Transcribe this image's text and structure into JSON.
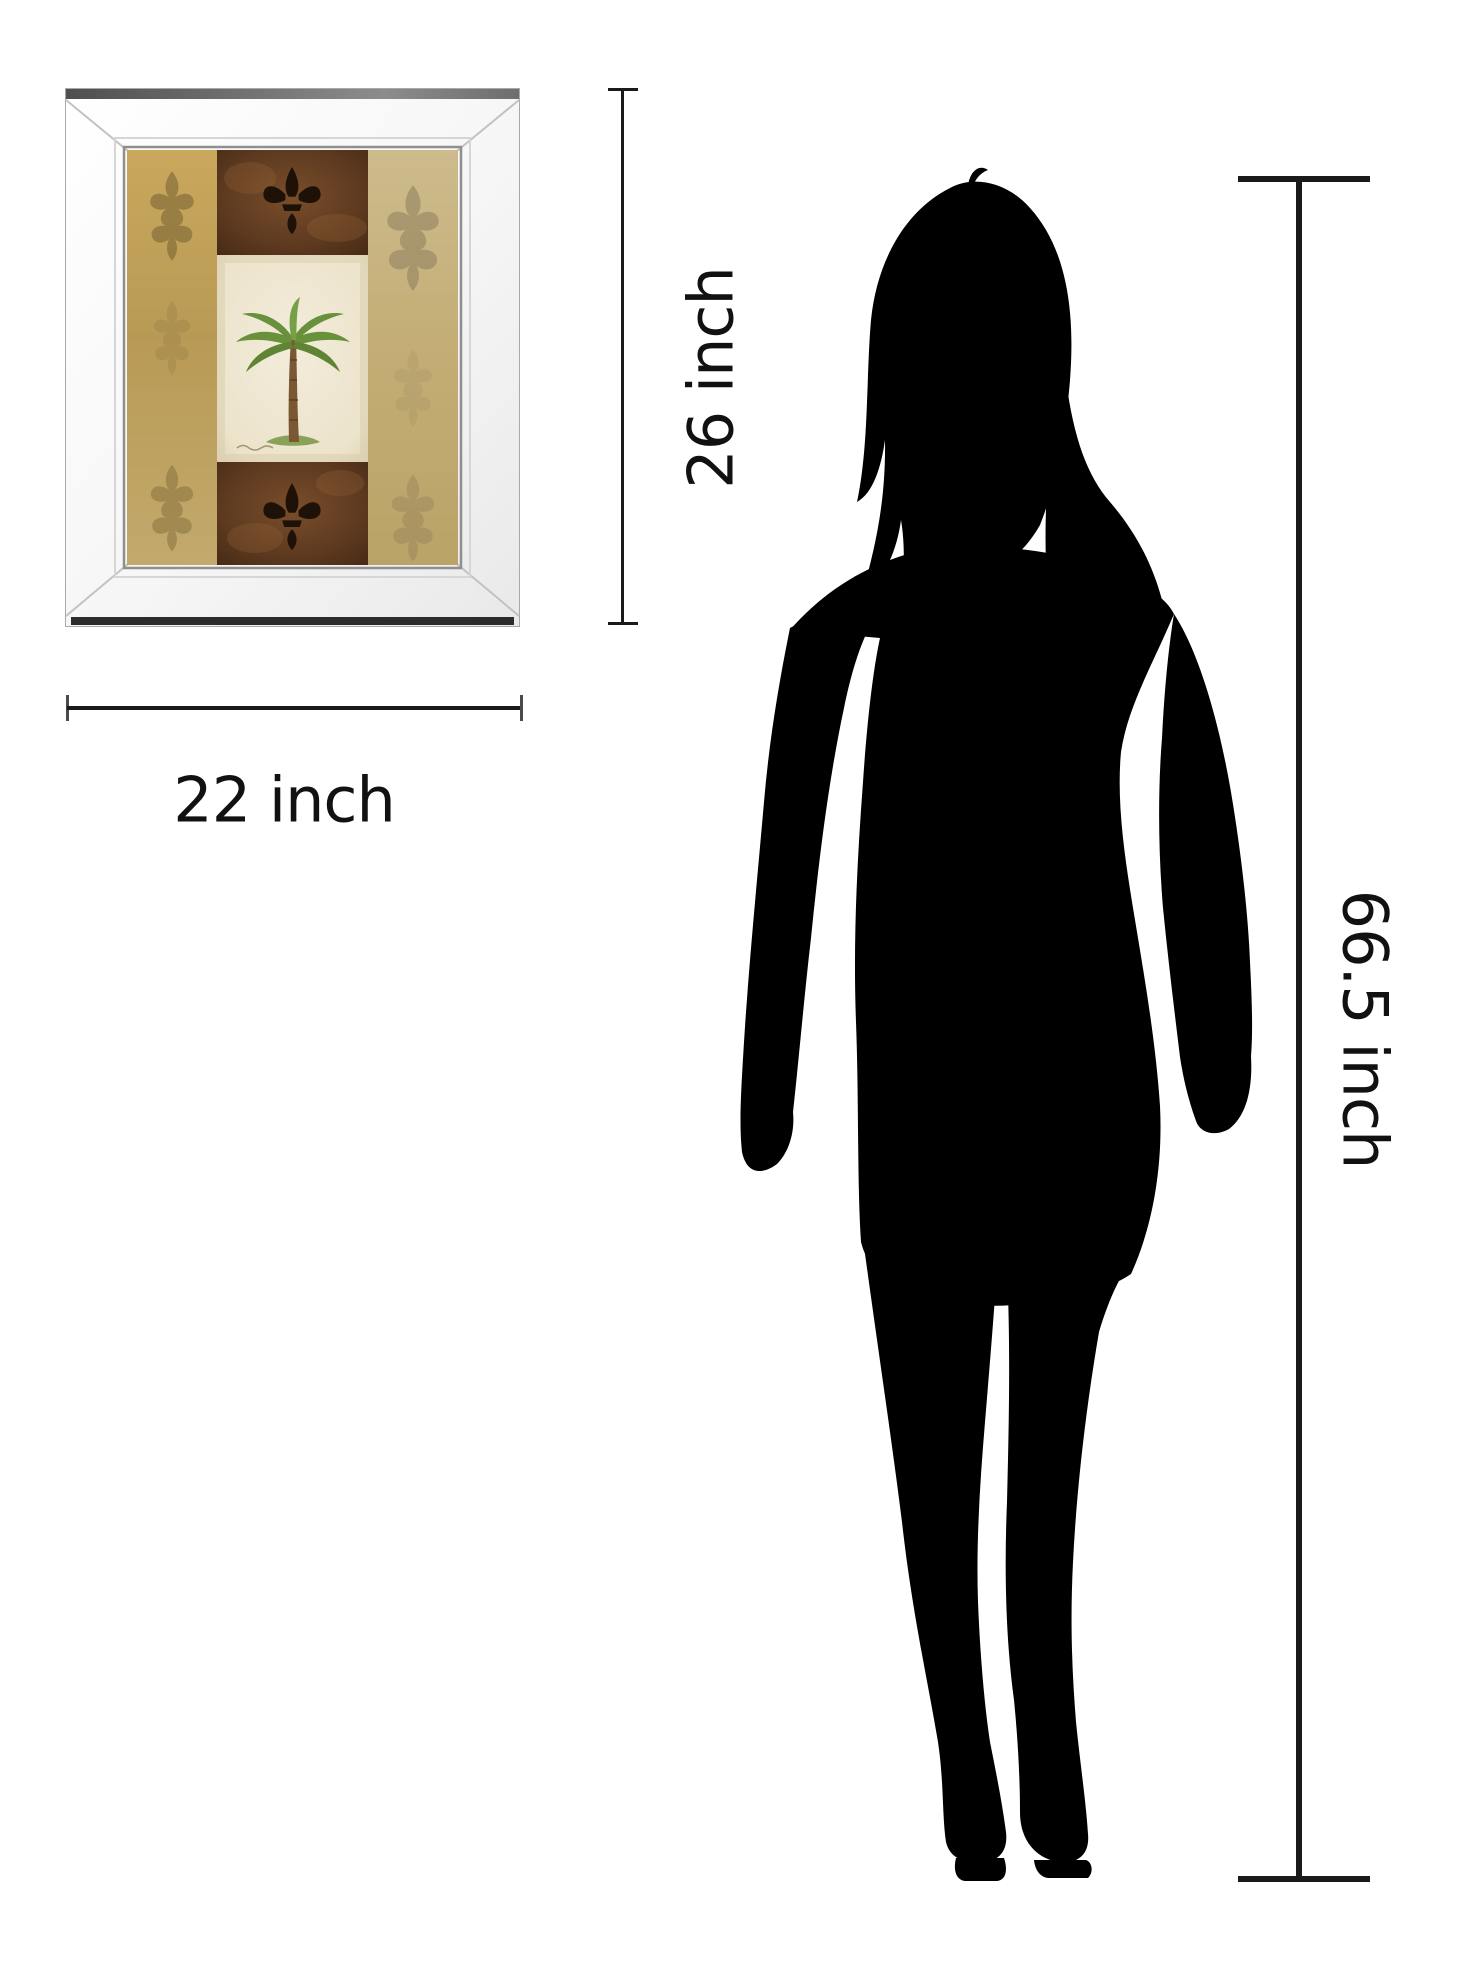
{
  "page": {
    "background": "#ffffff"
  },
  "dimensions": {
    "frame_height_label": "26 inch",
    "frame_width_label": "22 inch",
    "figure_height_label": "66.5 inch",
    "line_color": "#1a1a1a"
  },
  "product": {
    "name": "mirror-framed palm tree wall art",
    "frame_color": "#f5f5f5",
    "bevel_color": "#c2c2c2",
    "art": {
      "gold_tile": "#c6a65c",
      "tan_tile": "#c8b482",
      "brown_tile": "#5e3c22",
      "cream_tile": "#efe8d4",
      "palm_green": "#69913b",
      "trunk_brown": "#7a5833",
      "ornament_dark": "#20140a",
      "motifs": [
        "damask-pattern",
        "fleur-de-lis",
        "palm-tree"
      ]
    }
  },
  "figure": {
    "type": "woman silhouette",
    "color": "#000000"
  }
}
